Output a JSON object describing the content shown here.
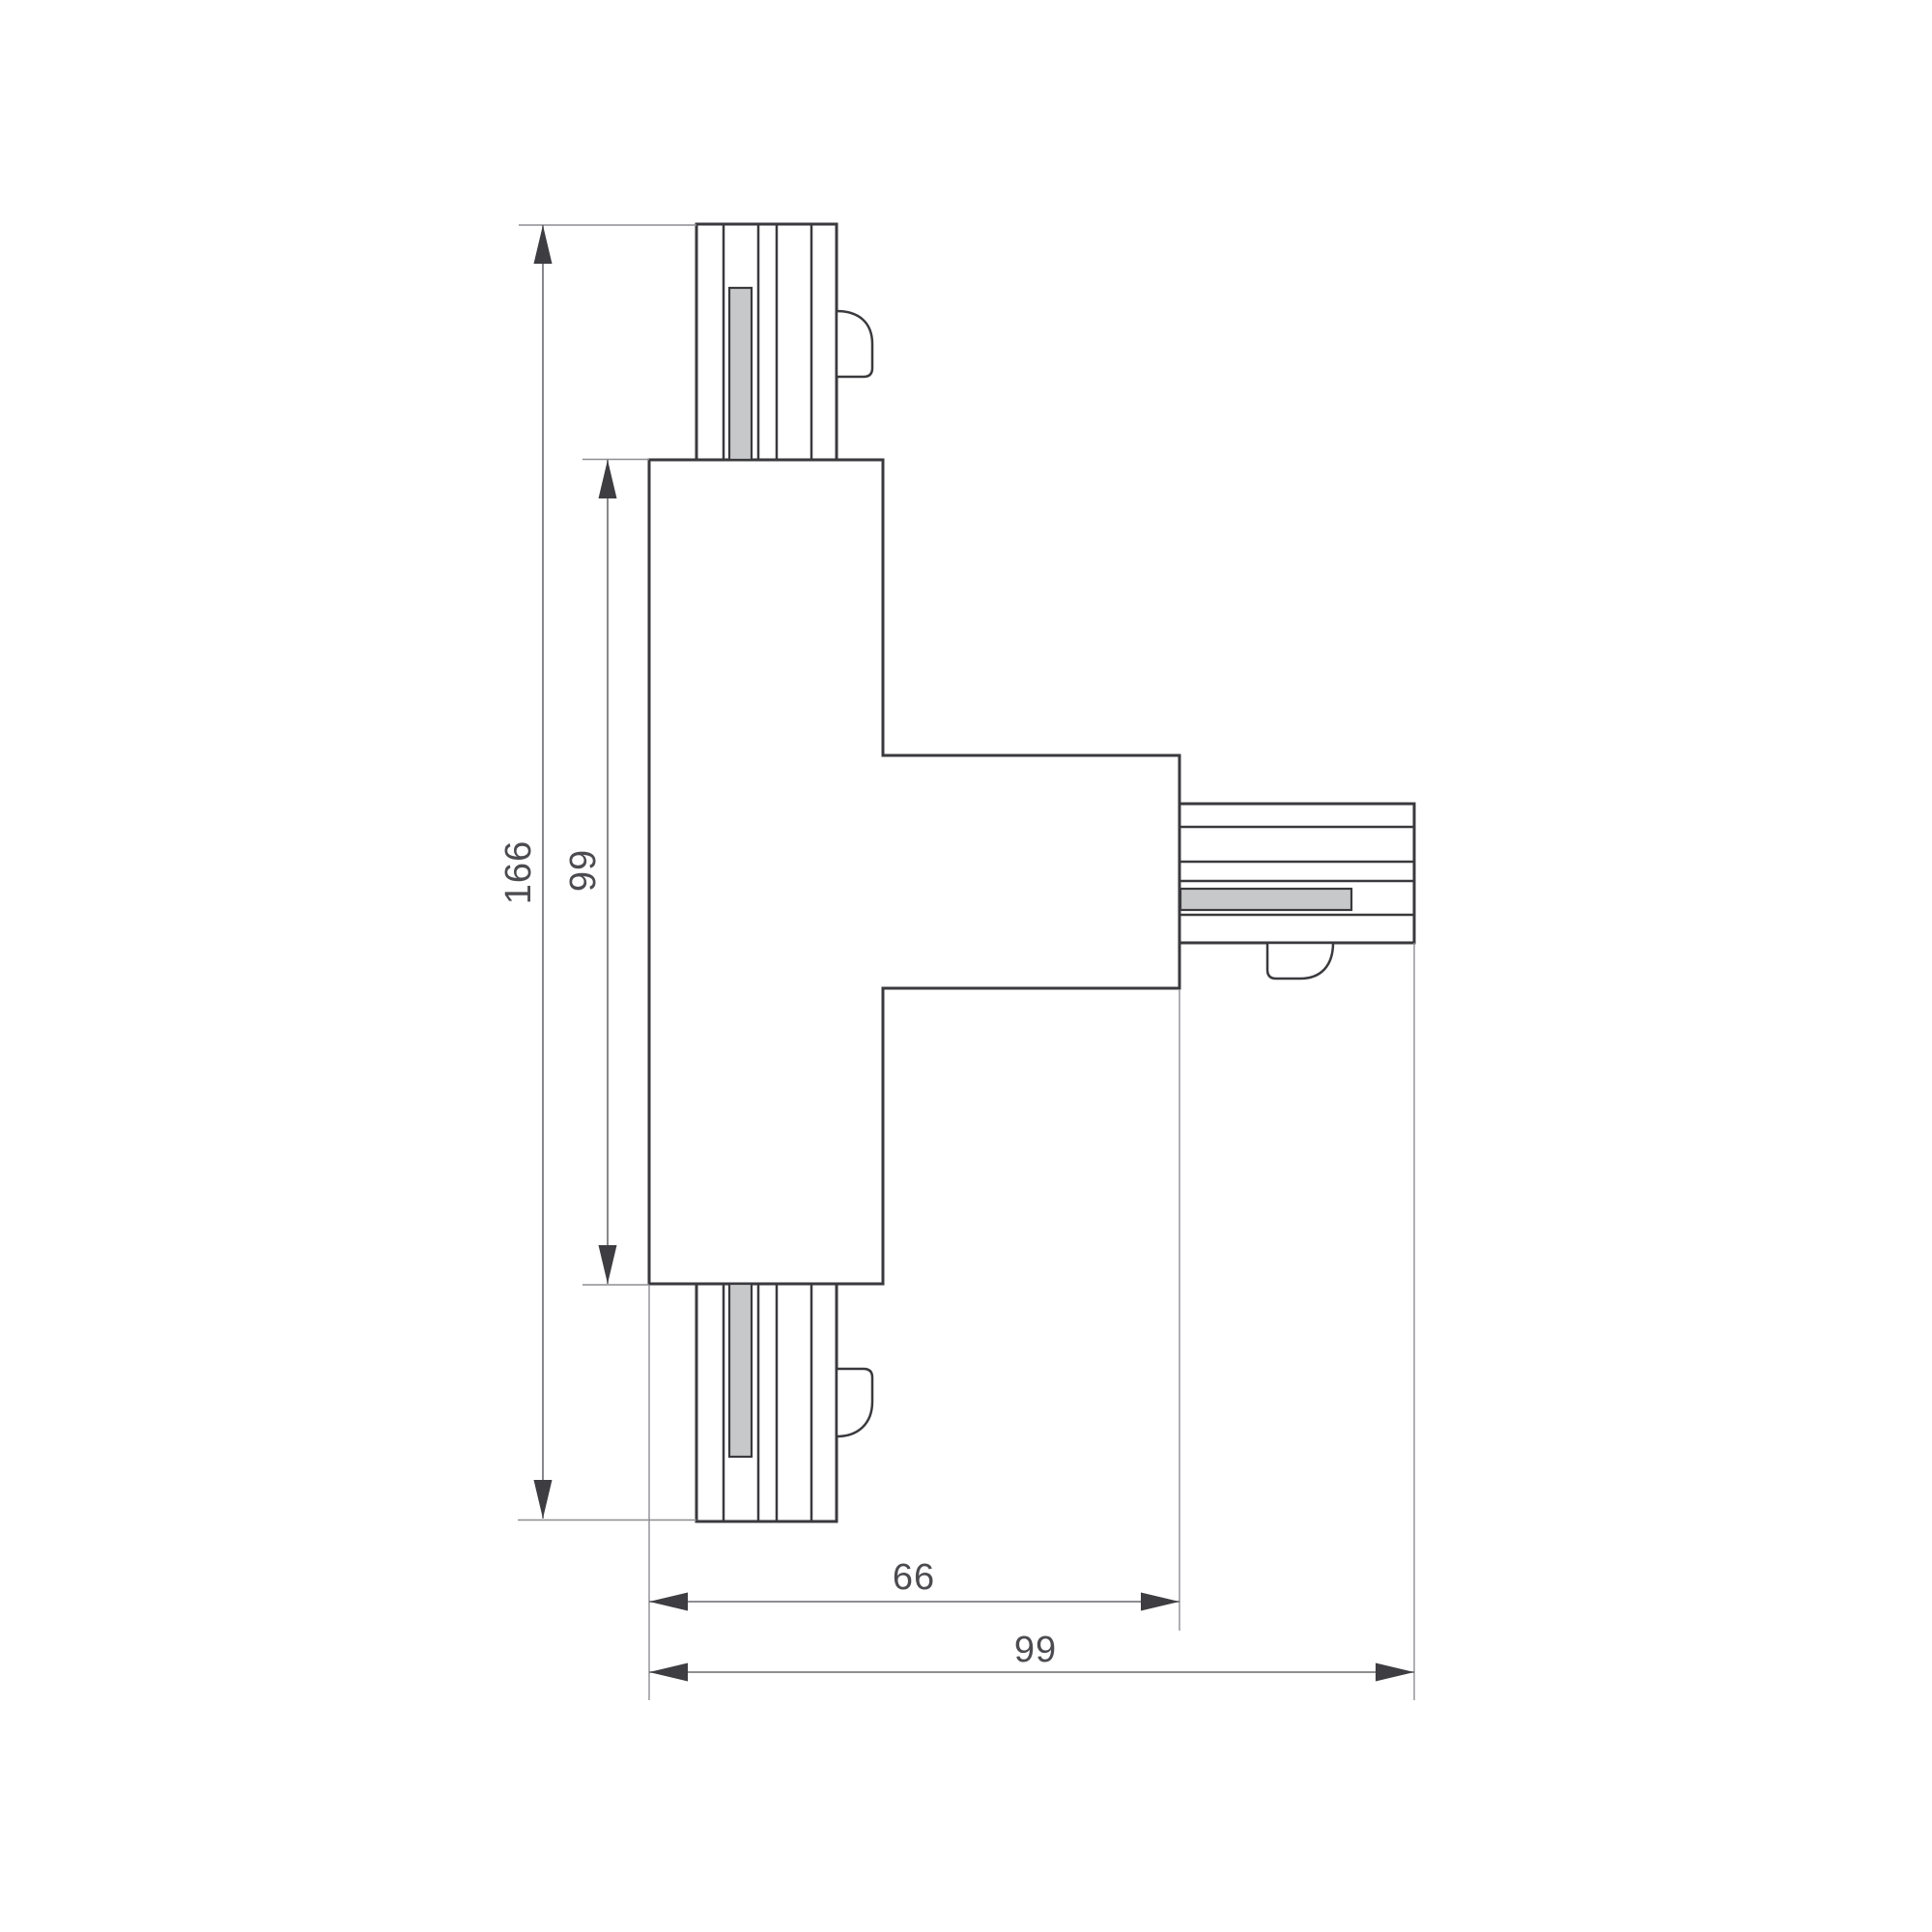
{
  "drawing": {
    "description": "T-shaped track connector dimensional drawing",
    "labels": {
      "overall_height": "166",
      "body_height": "99",
      "branch_width": "66",
      "overall_width": "99"
    },
    "colors": {
      "background": "#ffffff",
      "outline": "#3a3a3e",
      "dimension": "#6a6a6f",
      "extension": "#8e8e93",
      "arrow": "#3d3d42",
      "label_text": "#4b4b50",
      "slot_fill": "#c7c8c9"
    }
  }
}
